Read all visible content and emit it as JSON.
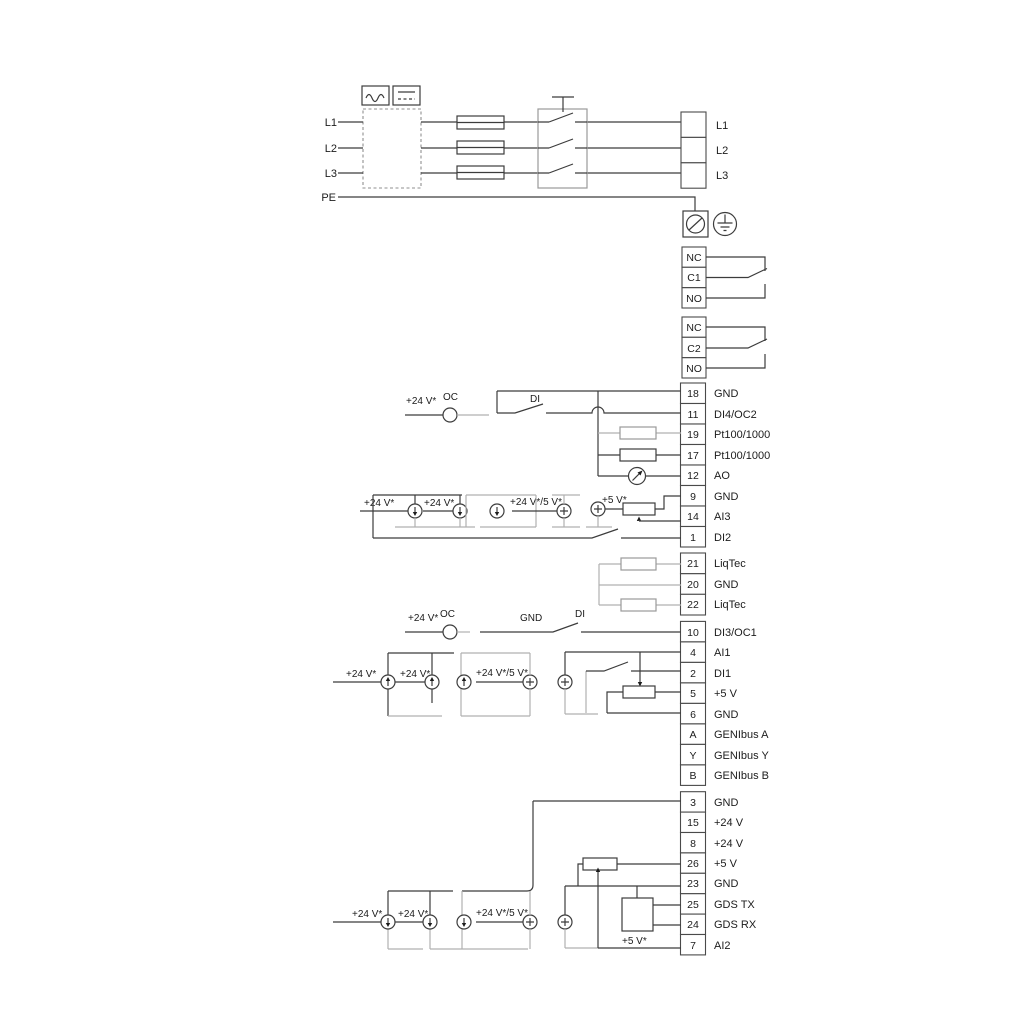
{
  "diagram_title": "Pump drive wiring diagram",
  "labels": {
    "v24": "+24 V*",
    "v24_5": "+24 V*/5 V*",
    "v5": "+5 V*",
    "oc": "OC",
    "di": "DI",
    "gnd": "GND"
  },
  "power": {
    "inputs": [
      "L1",
      "L2",
      "L3",
      "PE"
    ],
    "outputs": [
      "L1",
      "L2",
      "L3"
    ]
  },
  "relay1": {
    "rows": [
      "NC",
      "C1",
      "NO"
    ]
  },
  "relay2": {
    "rows": [
      "NC",
      "C2",
      "NO"
    ]
  },
  "stripA": {
    "rows": [
      {
        "num": "18",
        "label": "GND"
      },
      {
        "num": "11",
        "label": "DI4/OC2"
      },
      {
        "num": "19",
        "label": "Pt100/1000"
      },
      {
        "num": "17",
        "label": "Pt100/1000"
      },
      {
        "num": "12",
        "label": "AO"
      },
      {
        "num": "9",
        "label": "GND"
      },
      {
        "num": "14",
        "label": "AI3"
      },
      {
        "num": "1",
        "label": "DI2"
      }
    ]
  },
  "stripB": {
    "rows": [
      {
        "num": "21",
        "label": "LiqTec"
      },
      {
        "num": "20",
        "label": "GND"
      },
      {
        "num": "22",
        "label": "LiqTec"
      }
    ]
  },
  "stripC": {
    "rows": [
      {
        "num": "10",
        "label": "DI3/OC1"
      },
      {
        "num": "4",
        "label": "AI1"
      },
      {
        "num": "2",
        "label": "DI1"
      },
      {
        "num": "5",
        "label": "+5 V"
      },
      {
        "num": "6",
        "label": "GND"
      },
      {
        "num": "A",
        "label": "GENIbus A"
      },
      {
        "num": "Y",
        "label": "GENIbus Y"
      },
      {
        "num": "B",
        "label": "GENIbus B"
      }
    ]
  },
  "stripD": {
    "rows": [
      {
        "num": "3",
        "label": "GND"
      },
      {
        "num": "15",
        "label": "+24 V"
      },
      {
        "num": "8",
        "label": "+24 V"
      },
      {
        "num": "26",
        "label": "+5 V"
      },
      {
        "num": "23",
        "label": "GND"
      },
      {
        "num": "25",
        "label": "GDS TX"
      },
      {
        "num": "24",
        "label": "GDS RX"
      },
      {
        "num": "7",
        "label": "AI2"
      }
    ]
  },
  "icons": {
    "ac": "ac-sine-icon",
    "dc": "dc-symbol-icon",
    "fuse": "fuse-icon",
    "switch": "switch-contact-icon",
    "cable_gland": "cable-gland-icon",
    "earth": "earth-ground-icon",
    "current_source": "current-source-icon",
    "plus_source": "voltage-source-icon",
    "resistor": "resistor-icon",
    "potentiometer": "potentiometer-icon",
    "meter": "analog-output-meter-icon",
    "gds": "gds-sensor-box"
  }
}
